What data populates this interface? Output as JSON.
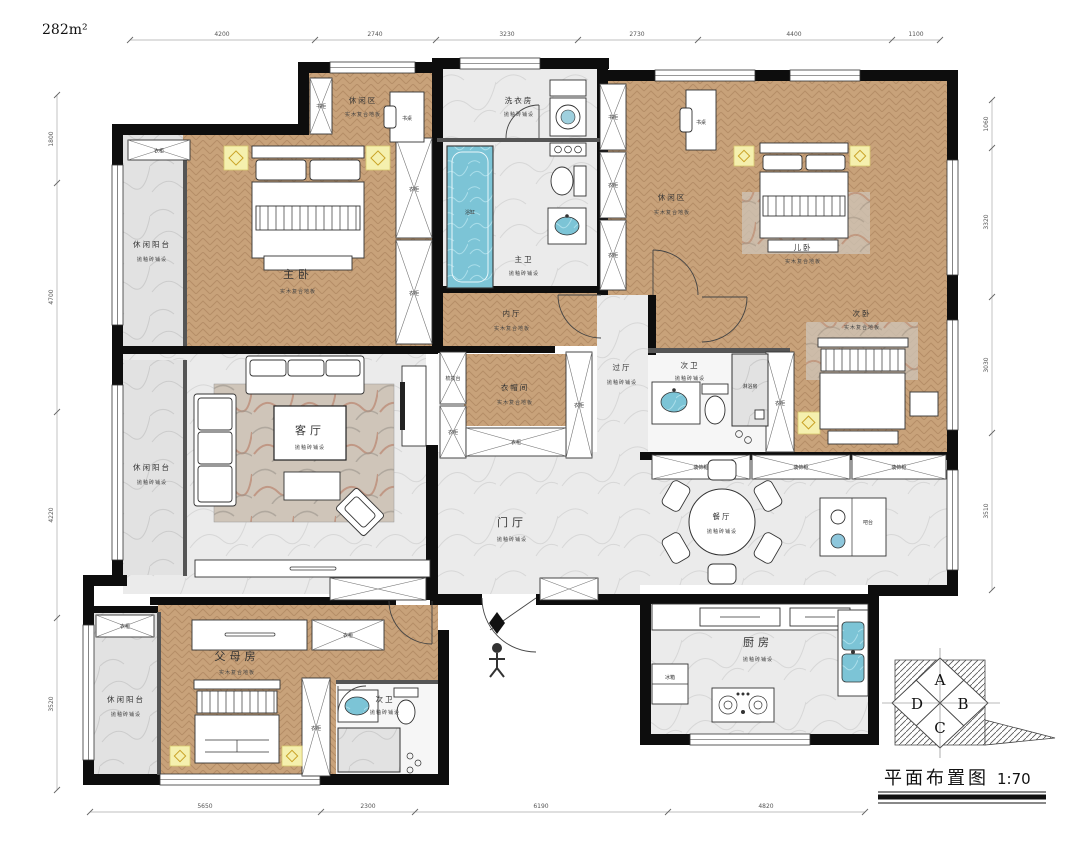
{
  "header": {
    "area_label": "282m²"
  },
  "title_block": {
    "title": "平面布置图",
    "scale": "1:70"
  },
  "compass": {
    "a": "A",
    "b": "B",
    "c": "C",
    "d": "D"
  },
  "rooms": {
    "master": "主卧",
    "leisure": "休闲区",
    "kids": "儿卧",
    "second": "次卧",
    "parents": "父母房",
    "inner_hall": "内厅",
    "cloak": "衣帽间",
    "living": "客厅",
    "foyer": "门厅",
    "dining": "餐厅",
    "kitchen": "厨房",
    "pass_hall": "过厅",
    "laundry": "洗衣房",
    "master_bath": "主卫",
    "second_bath": "次卫",
    "balcony": "休闲阳台"
  },
  "floors": {
    "wood": "实木复合地板",
    "tile": "抛釉砖铺设"
  },
  "furn": {
    "bookcase": "书柜",
    "desk": "书桌",
    "wardrobe": "衣柜",
    "dresser": "梳妆台",
    "bathtub": "浴缸",
    "shower": "淋浴房",
    "deco": "装饰柜",
    "bar": "吧台",
    "fridge": "冰箱"
  },
  "dimensions": {
    "top": [
      "4200",
      "2740",
      "3230",
      "2730",
      "4400",
      "1100"
    ],
    "bottom": [
      "5650",
      "2300",
      "6190",
      "4820"
    ],
    "left": [
      "1800",
      "4700",
      "4220",
      "3520"
    ],
    "right": [
      "1060",
      "3320",
      "3030",
      "3510"
    ]
  },
  "colors": {
    "wall": "#0d0d0d",
    "wood_floor": "#c8a27a",
    "tile_floor": "#ebebeb",
    "water": "#7cc4d6",
    "lamp": "#f5f0ae"
  }
}
